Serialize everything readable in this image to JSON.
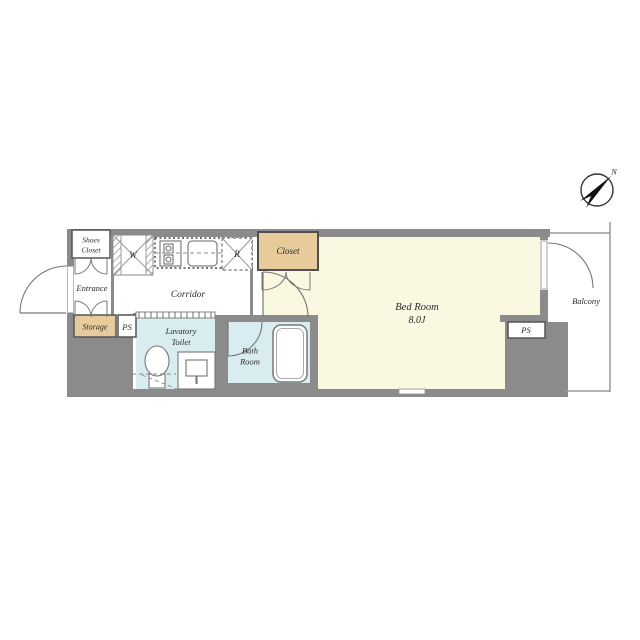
{
  "floorplan": {
    "compass": {
      "north": "N"
    },
    "labels": {
      "shoes_closet_line1": "Shoes",
      "shoes_closet_line2": "Closet",
      "entrance": "Entrance",
      "washer": "W",
      "corridor": "Corridor",
      "fridge": "R",
      "closet": "Closet",
      "bedroom_name": "Bed Room",
      "bedroom_size": "8.0J",
      "balcony": "Balcony",
      "storage": "Storage",
      "ps_left": "PS",
      "ps_right": "PS",
      "lavatory_line1": "Lavatory",
      "lavatory_line2": "Toilet",
      "bathroom_line1": "Bath",
      "bathroom_line2": "Room"
    },
    "colors": {
      "wall": "#8b8b8b",
      "room_cream": "#faf8e0",
      "closet_tan": "#e7cb9b",
      "wet_blue": "#d9edf0",
      "line": "#777777",
      "label_text": "#2a2a2a"
    }
  }
}
